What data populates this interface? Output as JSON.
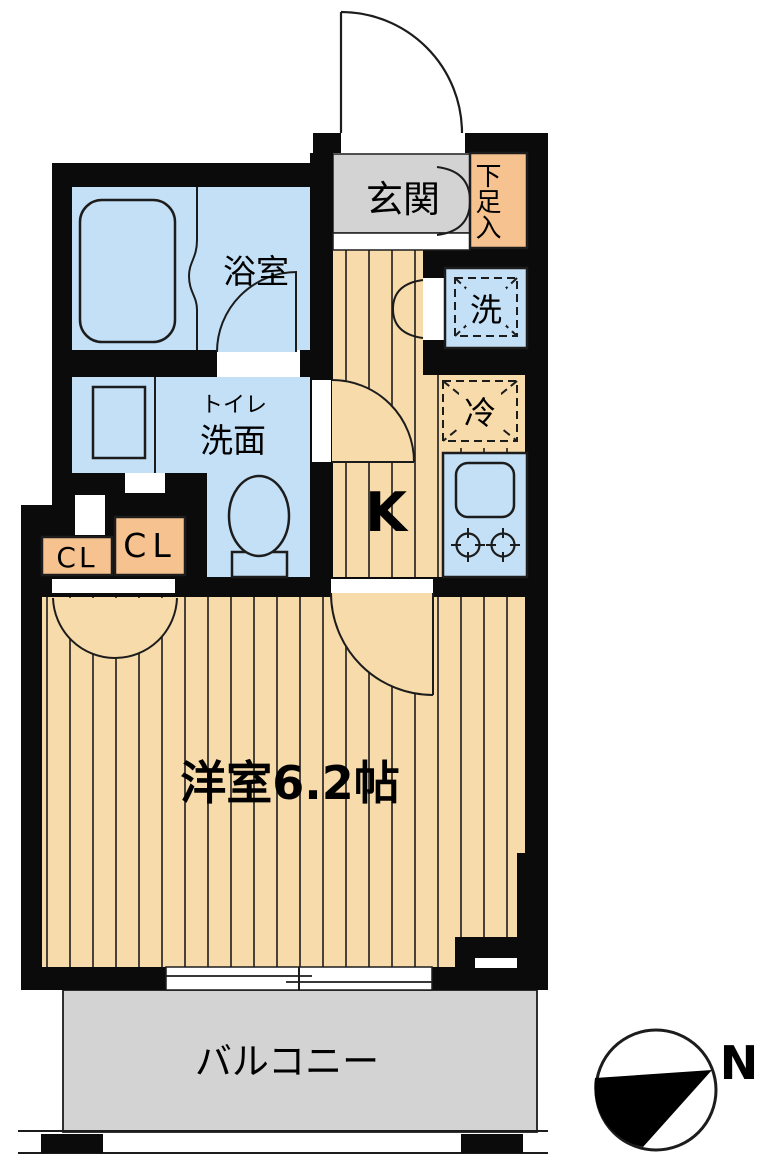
{
  "labels": {
    "genkan": "玄関",
    "shoe_storage": "下足入",
    "bathroom": "浴室",
    "toilet": "トイレ",
    "washstand": "洗面",
    "washer": "洗",
    "fridge": "冷",
    "kitchen": "K",
    "closet_left": "CL",
    "closet_right": "CL",
    "western_room": "洋室6.2帖",
    "balcony": "バルコニー",
    "north": "N"
  },
  "colors": {
    "wall": "#0b0b0b",
    "line": "#1c1c1c",
    "wood": "#f8dbaa",
    "orange": "#f6c28f",
    "blue": "#c3e0f6",
    "gray": "#d3d3d3"
  }
}
